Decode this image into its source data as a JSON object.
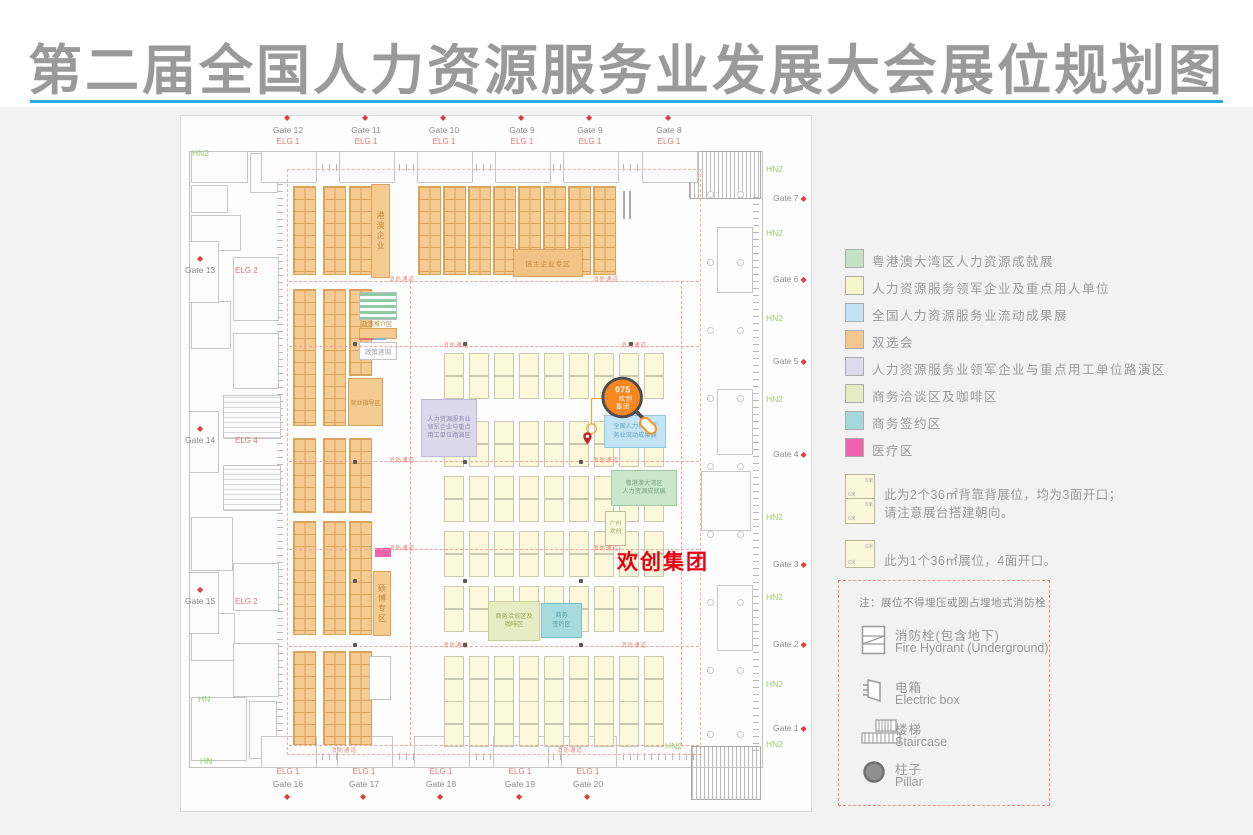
{
  "title": "第二届全国人力资源服务业发展大会展位规划图",
  "legend": {
    "items": [
      {
        "label": "粤港澳大湾区人力资源成就展",
        "color": "#C5E2C5"
      },
      {
        "label": "人力资源服务领军企业及重点用人单位",
        "color": "#F7F5C9"
      },
      {
        "label": "全国人力资源服务业流动成果展",
        "color": "#C3E3F4"
      },
      {
        "label": "双选会",
        "color": "#F3C78D"
      },
      {
        "label": "人力资源服务业领军企业与重点用工单位路演区",
        "color": "#DDDAEC"
      },
      {
        "label": "商务洽谈区及咖啡区",
        "color": "#E6ECC2"
      },
      {
        "label": "商务签约区",
        "color": "#A3D9DC"
      },
      {
        "label": "医疗区",
        "color": "#EF62AC"
      }
    ]
  },
  "booth_notes": {
    "size_label": "6米",
    "notes": [
      {
        "type": "double",
        "lines": [
          "此为2个36㎡背靠背展位，均为3面开口；",
          "请注意展台搭建朝向。"
        ]
      },
      {
        "type": "single",
        "lines": [
          "此为1个36㎡展位，4面开口。"
        ]
      }
    ]
  },
  "notice": {
    "title": "注：展位不得埋压或圈占埋地式消防栓",
    "items": [
      {
        "icon": "fire-hydrant-icon",
        "zh": "消防栓(包含地下)",
        "en": "Fire Hydrant (Underground)"
      },
      {
        "icon": "electric-box-icon",
        "zh": "电箱",
        "en": "Electric box"
      },
      {
        "icon": "staircase-icon",
        "zh": "楼梯",
        "en": "Staircase"
      },
      {
        "icon": "pillar-icon",
        "zh": "柱子",
        "en": "Pillar"
      }
    ]
  },
  "callout": {
    "number": "075",
    "name_lines": [
      "欢创",
      "集团"
    ]
  },
  "pin": {
    "label": "欢创集团"
  },
  "map": {
    "aisle_label": "消防通道",
    "gates": {
      "top": {
        "names": [
          "Gate 12",
          "Gate 11",
          "Gate 10",
          "Gate 9",
          "Gate 9",
          "Gate 8"
        ],
        "elg": "ELG 1"
      },
      "bottom": {
        "names": [
          "Gate 16",
          "Gate 17",
          "Gate 18",
          "Gate 19",
          "Gate 20"
        ],
        "elg": "ELG 1"
      },
      "left": [
        {
          "name": "Gate 13",
          "elg": "ELG 2"
        },
        {
          "name": "Gate 14",
          "elg": "ELG 4"
        },
        {
          "name": "Gate 15",
          "elg": "ELG 2"
        }
      ],
      "right": {
        "names": [
          "Gate 7",
          "Gate 6",
          "Gate 5",
          "Gate 4",
          "Gate 3",
          "Gate 2",
          "Gate 1"
        ]
      }
    },
    "corridor": {
      "side": "HN2",
      "corner": "HN"
    },
    "zones": {
      "hk_macau_strip": "港澳企业",
      "phd_strip": "硕博专区",
      "employment_guidance": "就业指导区",
      "chain_leader": "链主企业专区",
      "policy_promo": "政策推介区",
      "policy_consult": "政策咨询",
      "roadshow_lines": [
        "人力资源服务业",
        "领军企业与重点",
        "用工单位路演区"
      ],
      "mobile_achievements_lines": [
        "全国人力资源服",
        "务业流动成果展"
      ],
      "gba_achievements_lines": [
        "粤港澳大湾区",
        "人力资源成就展"
      ],
      "biz_talk_lines": [
        "商务洽谈区及",
        "咖啡区"
      ],
      "biz_signing_lines": [
        "商务",
        "签约区"
      ],
      "booth_075_lines": [
        "广州",
        "欢创"
      ]
    }
  },
  "colors": {
    "accent_orange": "#F5871E",
    "ring_gray": "#4D4D4F",
    "pin_red": "#C1272D",
    "label_red": "#E60012",
    "line_blue": "#29ABE2",
    "title_gray": "#9A9A9A"
  }
}
